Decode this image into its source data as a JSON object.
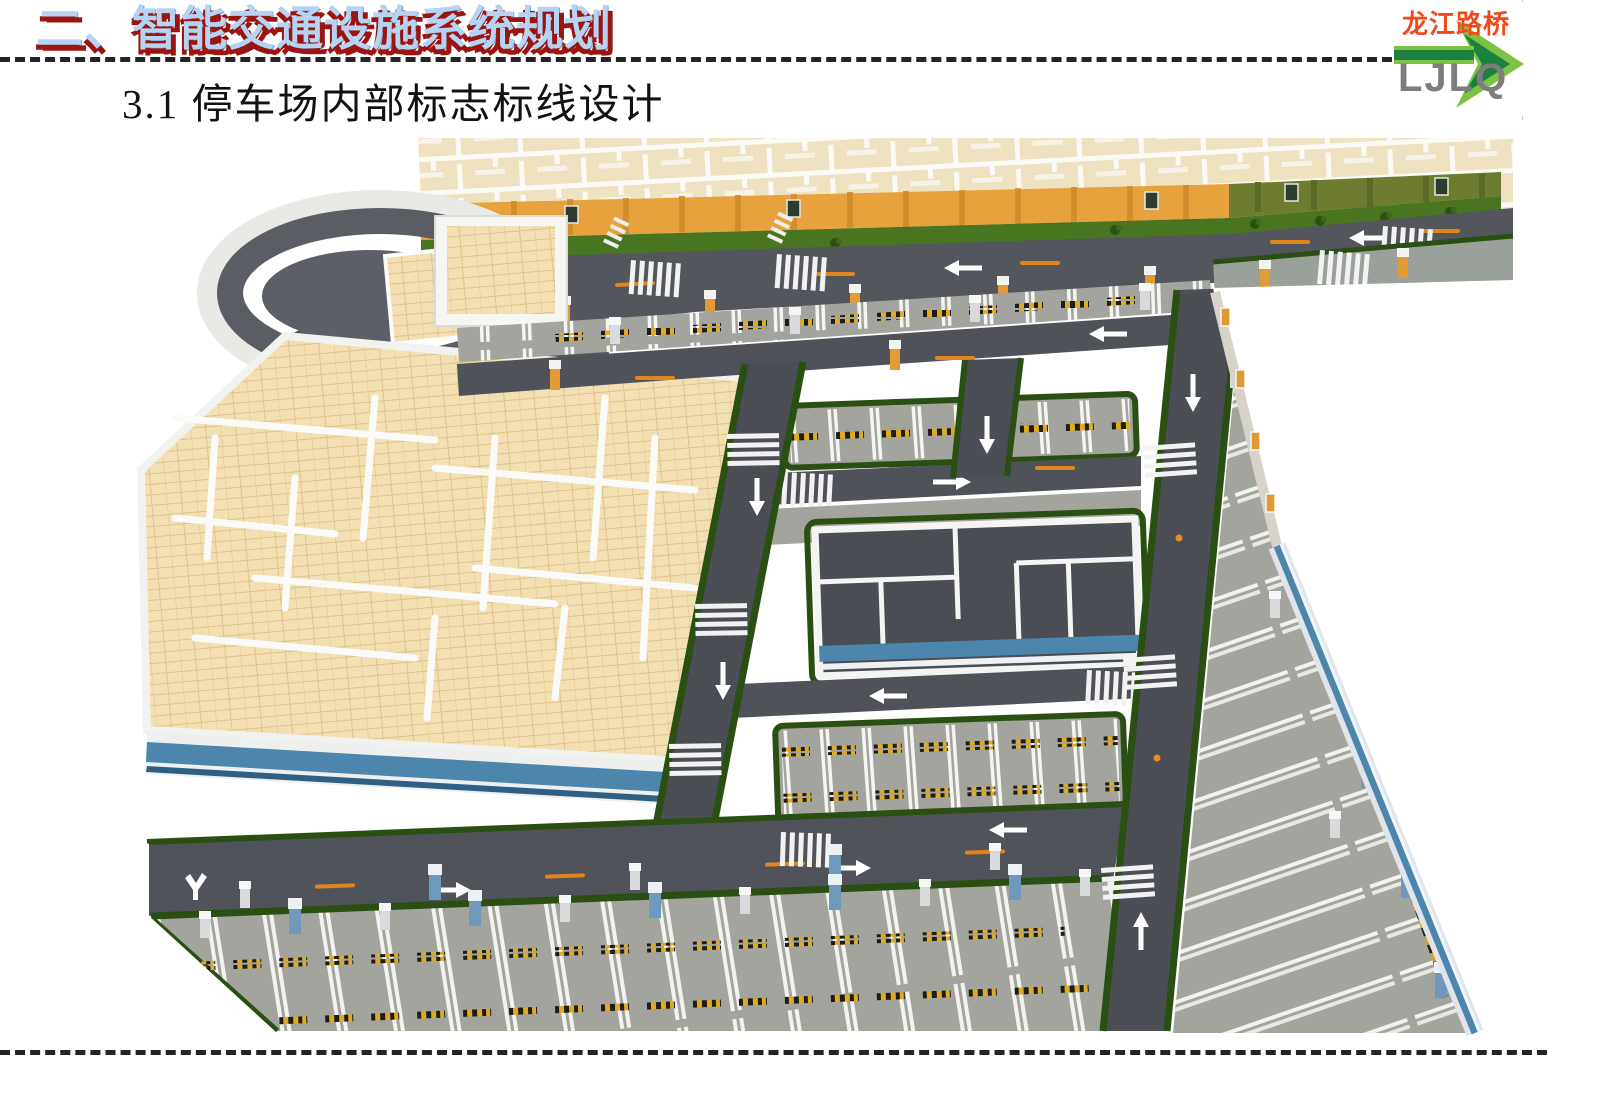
{
  "header": {
    "section_title": "二、智能交通设施系统规划",
    "subtitle": "3.1 停车场内部标志标线设计"
  },
  "logo": {
    "company_name": "龙江路桥",
    "abbr": "LJLQ"
  },
  "colors": {
    "title_fill": "#b5d3f2",
    "title_shadow": "#9b1410",
    "logo_orange": "#f2491a",
    "logo_green_dark": "#1c8040",
    "logo_green_light": "#7dc242",
    "logo_gray": "#7d7d7d",
    "road_asphalt": "#515459",
    "parking_surface": "#a3a49d",
    "curb_green": "#2b4f13",
    "grass_green": "#4a7520",
    "boundary_wall_orange": "#e7a23e",
    "boundary_wall_olive": "#6d7c2e",
    "floor_tan": "#f3e0b2",
    "building_stripe_blue": "#4d86ad"
  }
}
